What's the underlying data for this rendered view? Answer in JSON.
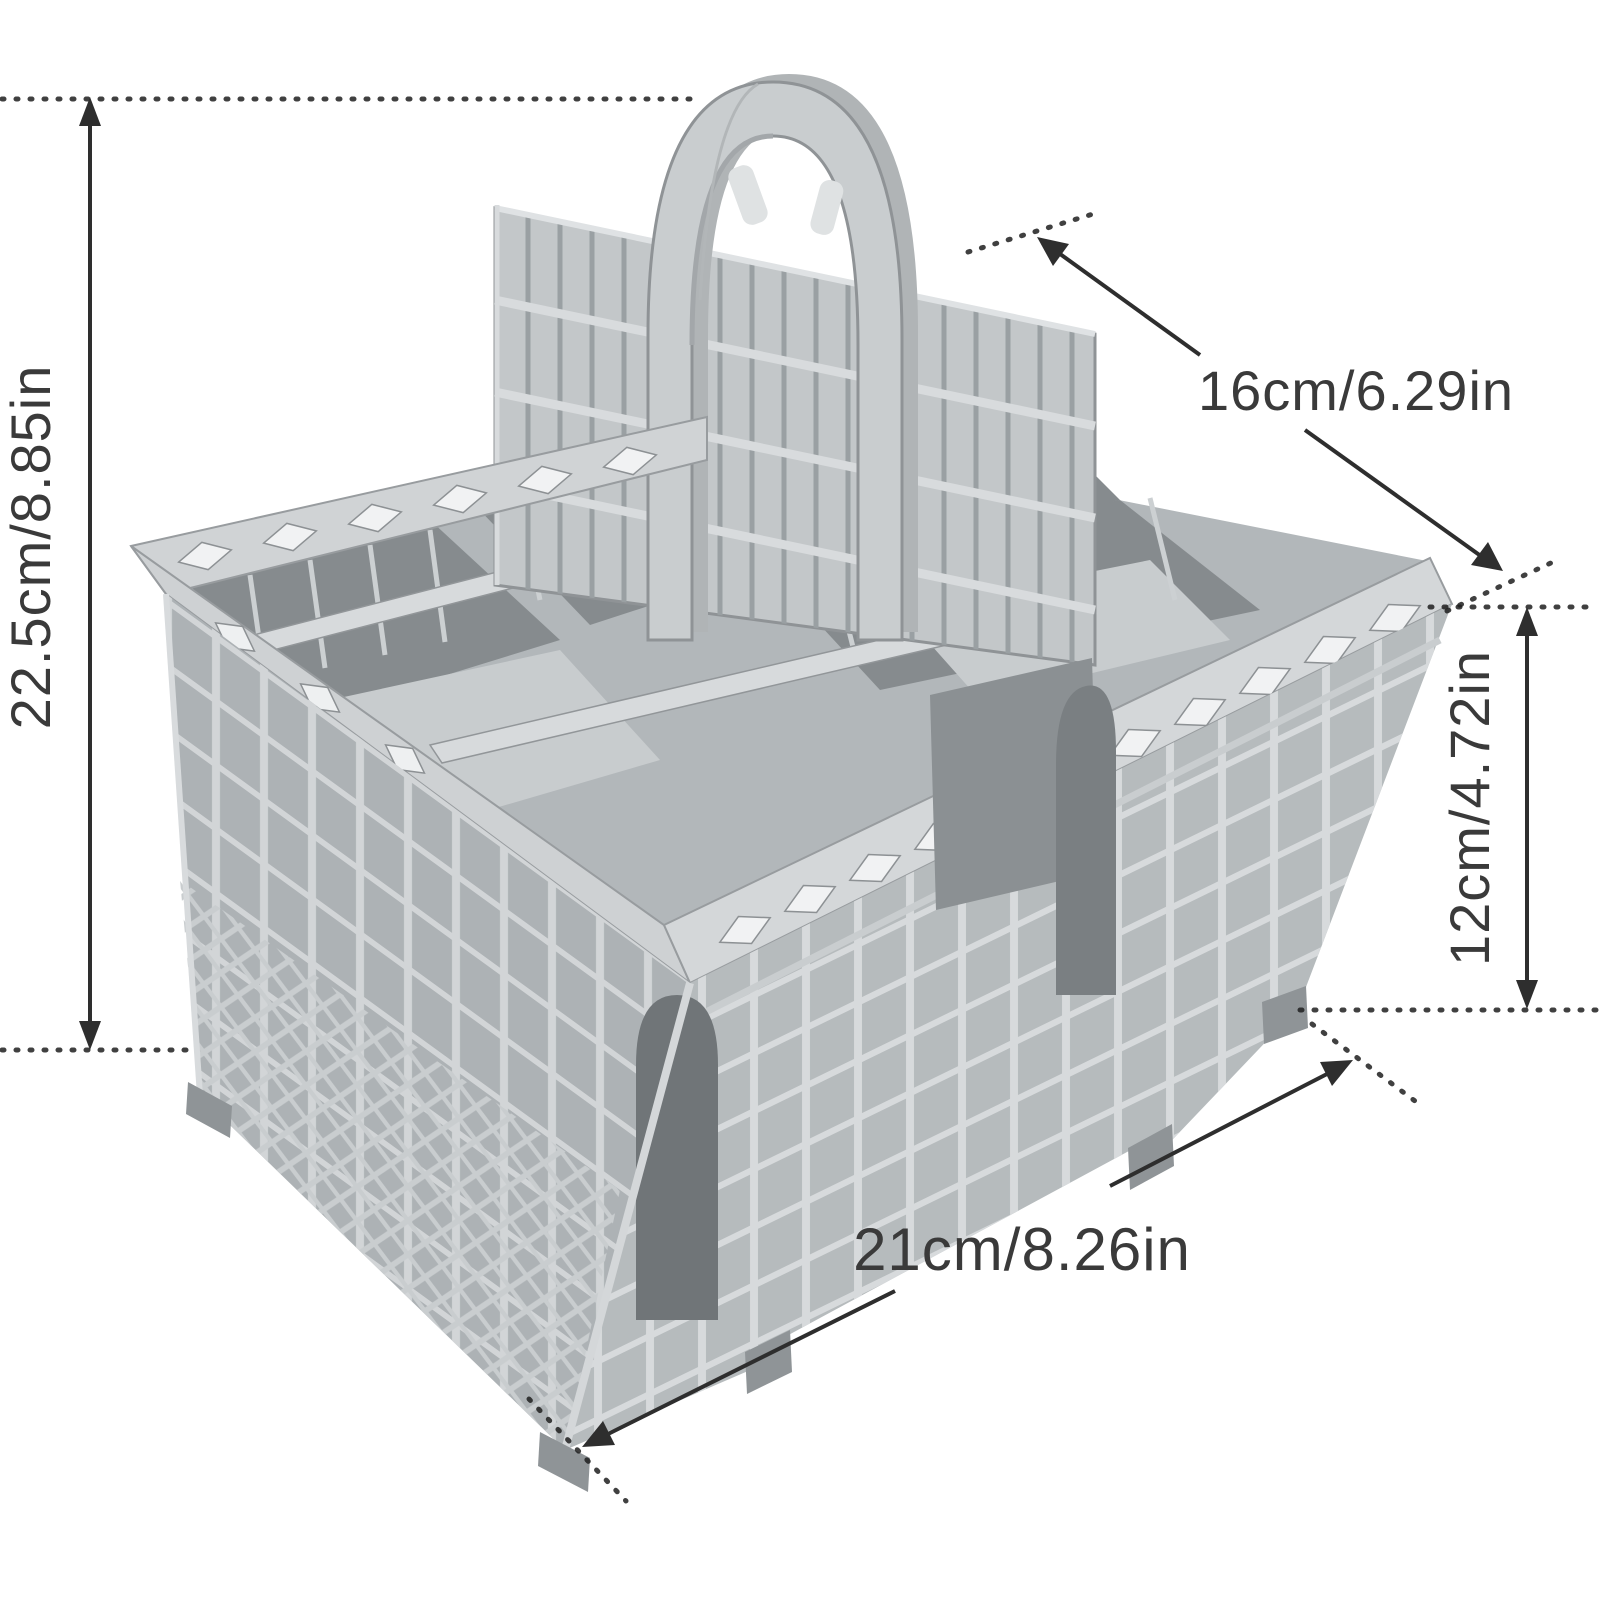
{
  "figure": {
    "background_color": "#ffffff",
    "product": "dishwasher-cutlery-basket",
    "product_color": "#b5babc",
    "product_highlight_color": "#d7dadc",
    "product_shadow_color": "#86*8b8e",
    "annotation_text_color": "#3a3a3a",
    "annotation_line_color": "#2e2e2e"
  },
  "dimensions": {
    "overall_height": {
      "label": "22.5cm/8.85in",
      "cm": 22.5,
      "inches": 8.85,
      "position": "left",
      "orientation": "vertical-rotated"
    },
    "top_width": {
      "label": "16cm/6.29in",
      "cm": 16,
      "inches": 6.29,
      "position": "top-right",
      "orientation": "diagonal"
    },
    "basket_height": {
      "label": "12cm/4.72in",
      "cm": 12,
      "inches": 4.72,
      "position": "right",
      "orientation": "vertical-rotated"
    },
    "length": {
      "label": "21cm/8.26in",
      "cm": 21,
      "inches": 8.26,
      "position": "bottom",
      "orientation": "diagonal"
    }
  }
}
